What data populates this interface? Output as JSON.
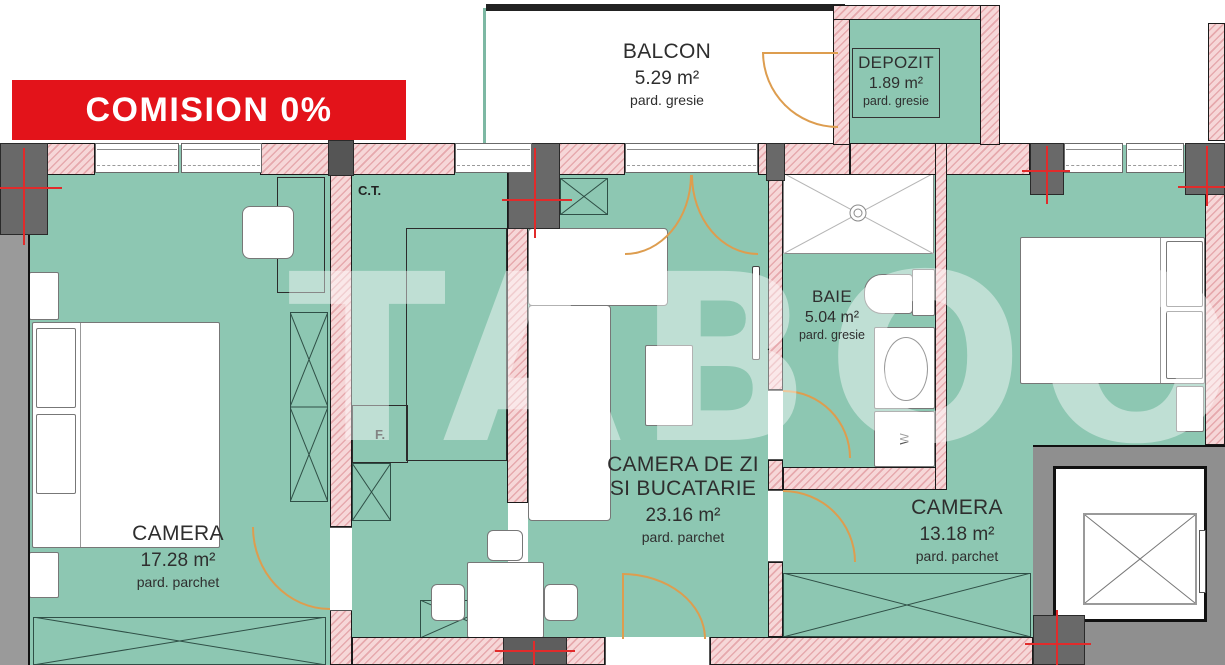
{
  "badge": {
    "label": "COMISION 0%"
  },
  "watermark": {
    "text": "TABOO"
  },
  "rooms": {
    "balcon": {
      "name": "BALCON",
      "area": "5.29 m²",
      "floor": "pard. gresie"
    },
    "depozit": {
      "name": "DEPOZIT",
      "area": "1.89 m²",
      "floor": "pard. gresie"
    },
    "camera1": {
      "name": "CAMERA",
      "area": "17.28 m²",
      "floor": "pard. parchet"
    },
    "living": {
      "name_line1": "CAMERA DE ZI",
      "name_line2": "SI BUCATARIE",
      "area": "23.16 m²",
      "floor": "pard. parchet"
    },
    "baie": {
      "name": "BAIE",
      "area": "5.04 m²",
      "floor": "pard. gresie"
    },
    "camera2": {
      "name": "CAMERA",
      "area": "13.18 m²",
      "floor": "pard. parchet"
    }
  },
  "annotations": {
    "boiler": "C.T.",
    "fridge": "F.",
    "washer": "W"
  },
  "colors": {
    "badge_red": "#e3131a",
    "room_teal": "#8dc7b2",
    "wall_pink": "#f6d7d8",
    "wall_hatch_stripe": "#e6a9ad",
    "wall_outline": "#1a1a1a",
    "pillar_gray": "#696969",
    "wall_gray": "#9a9a9a",
    "door_orange": "#dd9d4f",
    "marker_red": "#e12b2b",
    "watermark_white": "rgba(255,255,255,0.44)"
  }
}
